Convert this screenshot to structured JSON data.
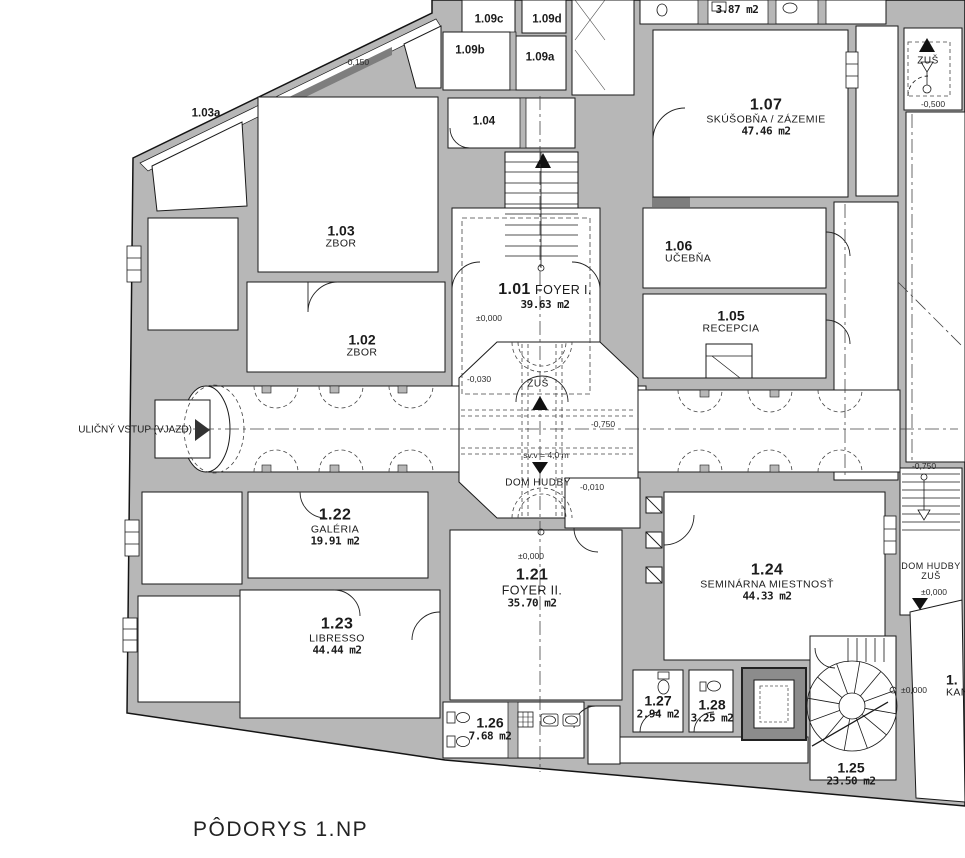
{
  "title": {
    "text": "PÔDORYS 1.NP",
    "x": 193,
    "y": 818
  },
  "drawing": {
    "type": "architectural floor plan",
    "floor": "1.NP"
  },
  "colors": {
    "background": "#ffffff",
    "wall_fill": "#b7b7b7",
    "wall_dark": "#7e7e7e",
    "line": "#1a1a1a"
  },
  "rooms": [
    {
      "id": "1.01",
      "name": "FOYER I.",
      "area": "39.63 m2",
      "x": 545,
      "y": 296
    },
    {
      "id": "1.02",
      "name": "ZBOR",
      "x": 362,
      "y": 346
    },
    {
      "id": "1.03",
      "name": "ZBOR",
      "x": 341,
      "y": 237
    },
    {
      "id": "1.03a",
      "x": 206,
      "y": 114
    },
    {
      "id": "1.04",
      "x": 484,
      "y": 122
    },
    {
      "id": "1.05",
      "name": "RECEPCIA",
      "x": 731,
      "y": 322
    },
    {
      "id": "1.06",
      "name": "UČEBŇA",
      "x": 665,
      "y": 252
    },
    {
      "id": "1.07",
      "name": "SKÚŠOBŇA / ZÁZEMIE",
      "area": "47.46 m2",
      "x": 766,
      "y": 117
    },
    {
      "id": "1.09a",
      "x": 540,
      "y": 58
    },
    {
      "id": "1.09b",
      "x": 470,
      "y": 51
    },
    {
      "id": "1.09c",
      "x": 489,
      "y": 20
    },
    {
      "id": "1.09d",
      "x": 547,
      "y": 20
    },
    {
      "id": "1.21",
      "name": "FOYER II.",
      "area": "35.70 m2",
      "x": 532,
      "y": 588
    },
    {
      "id": "1.22",
      "name": "GALÉRIA",
      "area": "19.91 m2",
      "x": 335,
      "y": 527
    },
    {
      "id": "1.23",
      "name": "LIBRESSO",
      "area": "44.44 m2",
      "x": 337,
      "y": 636
    },
    {
      "id": "1.24",
      "name": "SEMINÁRNA MIESTNOSŤ",
      "area": "44.33 m2",
      "x": 767,
      "y": 582
    },
    {
      "id": "1.25",
      "area": "23.50 m2",
      "x": 851,
      "y": 774
    },
    {
      "id": "1.26",
      "area": "7.68 m2",
      "x": 490,
      "y": 729
    },
    {
      "id": "1.27",
      "area": "2.94 m2",
      "x": 658,
      "y": 707
    },
    {
      "id": "1.28",
      "area": "3.25 m2",
      "x": 712,
      "y": 711
    },
    {
      "id": "1.",
      "name": "KAN",
      "x": 946,
      "y": 686
    },
    {
      "area": "3.87 m2",
      "x": 737,
      "y": 10
    }
  ],
  "elevations": [
    {
      "text": "-0,150",
      "x": 357,
      "y": 62
    },
    {
      "text": "-0,500",
      "x": 933,
      "y": 104
    },
    {
      "text": "±0,000",
      "x": 489,
      "y": 318
    },
    {
      "text": "-0,030",
      "x": 479,
      "y": 379
    },
    {
      "text": "-0,750",
      "x": 603,
      "y": 424
    },
    {
      "text": "sv.v = 4,0 m",
      "x": 546,
      "y": 455
    },
    {
      "text": "-0,010",
      "x": 592,
      "y": 487
    },
    {
      "text": "±0,000",
      "x": 531,
      "y": 556
    },
    {
      "text": "-0,750",
      "x": 924,
      "y": 466
    },
    {
      "text": "±0,000",
      "x": 934,
      "y": 592
    },
    {
      "text": "±0,000",
      "x": 914,
      "y": 690
    }
  ],
  "markers": [
    {
      "label": "ZUŠ",
      "direction": "up",
      "x": 538,
      "y": 384
    },
    {
      "label": "DOM HUDBY",
      "direction": "down",
      "x": 538,
      "y": 483
    },
    {
      "label": "ZUŠ",
      "direction": "up",
      "x": 928,
      "y": 61
    },
    {
      "line1": "DOM HUDBY",
      "line2": "ZUŠ",
      "direction": "down",
      "x": 931,
      "y": 572
    }
  ],
  "entry": {
    "label": "ULIČNÝ VSTUP (VJAZD)",
    "x": 192,
    "y": 430
  }
}
